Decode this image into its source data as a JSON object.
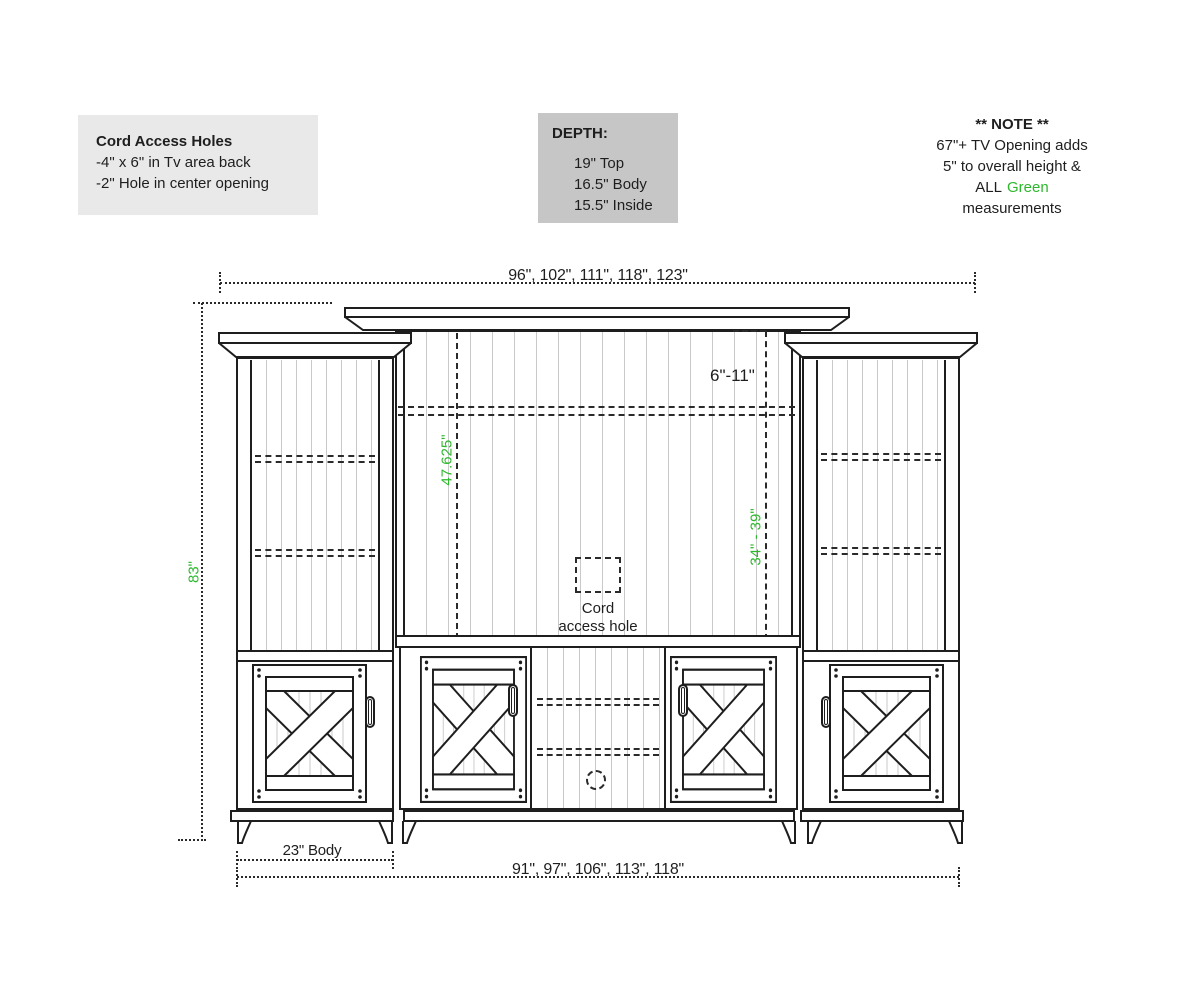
{
  "notes": {
    "cord_access": {
      "title": "Cord Access Holes",
      "lines": [
        "-4\" x 6\" in Tv area back",
        "-2\" Hole in center opening"
      ]
    },
    "depth": {
      "title": "DEPTH:",
      "lines": [
        "19\" Top",
        "16.5\" Body",
        "15.5\" Inside"
      ]
    },
    "note": {
      "title": "** NOTE **",
      "line1": "67\"+ TV Opening adds",
      "line2": "5\" to overall height &",
      "line3_before": "ALL",
      "line3_green": "Green",
      "line4": "measurements"
    }
  },
  "dimensions": {
    "top_widths": "96\", 102\", 111\", 118\", 123\"",
    "bottom_widths": "91\", 97\", 106\", 113\", 118\"",
    "side_body": "23\" Body",
    "overall_height": "83\"",
    "tv_opening_height": "47.625\"",
    "tv_height_range": "34\" - 39\"",
    "top_gap_range": "6\"-11\"",
    "cord_hole": {
      "line1": "Cord",
      "line2": "access hole"
    }
  },
  "colors": {
    "green": "#2eb82e",
    "box_light": "#e9e9e9",
    "box_dark": "#c6c6c6",
    "line": "#1e1e1e"
  }
}
